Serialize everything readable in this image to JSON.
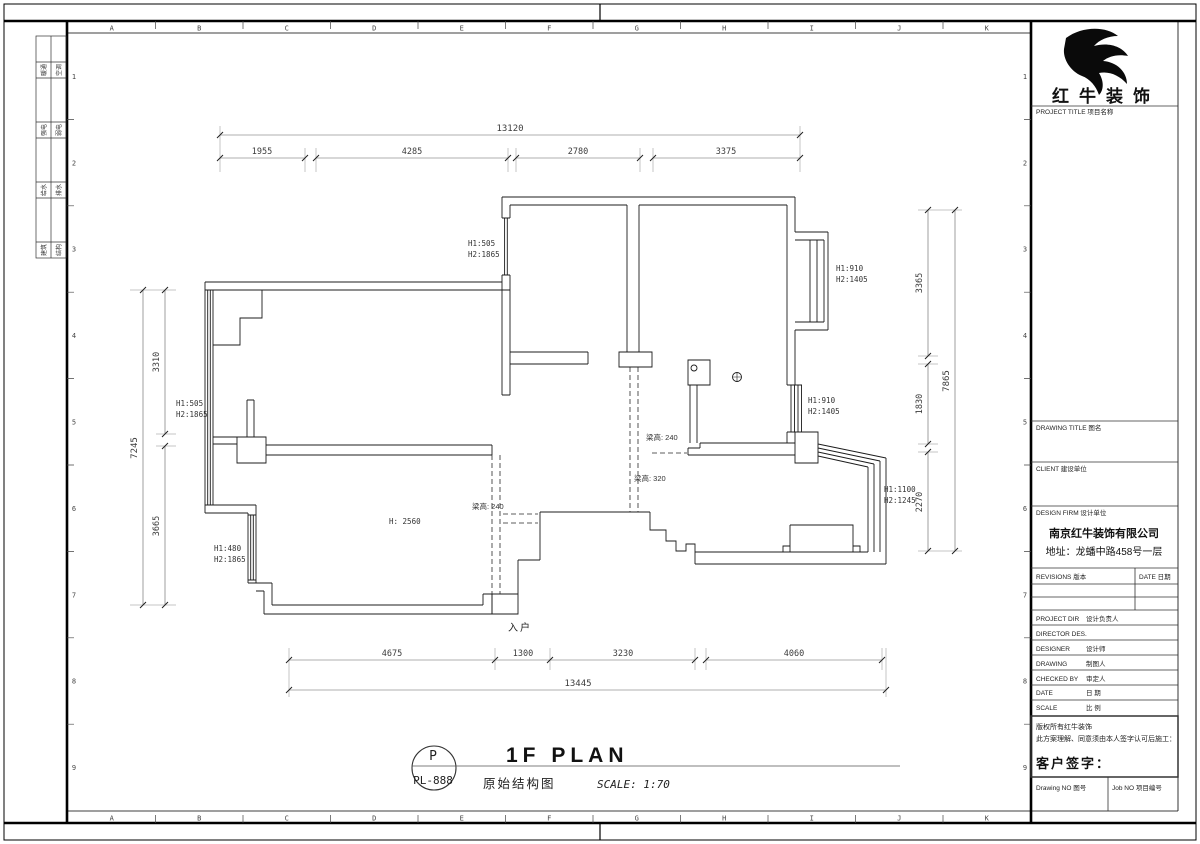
{
  "sheet": {
    "grid_letters": [
      "A",
      "B",
      "C",
      "D",
      "E",
      "F",
      "G",
      "H",
      "I",
      "J",
      "K"
    ],
    "grid_numbers": [
      "1",
      "2",
      "3",
      "4",
      "5",
      "6",
      "7",
      "8",
      "9"
    ]
  },
  "signoff": {
    "rows": [
      {
        "left": "暖通",
        "right": "空调"
      },
      {
        "left": "强电",
        "right": "弱电"
      },
      {
        "left": "给水",
        "right": "排水"
      },
      {
        "left": "建筑",
        "right": "结构"
      }
    ]
  },
  "dims": {
    "top": {
      "overall": "13120",
      "segments": [
        "1955",
        "4285",
        "2780",
        "3375"
      ]
    },
    "left": {
      "overall": "7245",
      "segments": [
        "3310",
        "3665"
      ]
    },
    "right": {
      "overall": "7865",
      "segments": [
        "3365",
        "1830",
        "2270"
      ]
    },
    "bottom": {
      "overall": "13445",
      "segments": [
        "4675",
        "1300",
        "3230",
        "4060"
      ]
    }
  },
  "plan": {
    "entry": "入户",
    "room_height": "H: 2560",
    "openings": [
      {
        "l1": "H1:505",
        "l2": "H2:1865"
      },
      {
        "l1": "H1:910",
        "l2": "H2:1405"
      },
      {
        "l1": "H1:505",
        "l2": "H2:1865"
      },
      {
        "l1": "H1:910",
        "l2": "H2:1405"
      },
      {
        "l1": "H1:1100",
        "l2": "H2:1245"
      },
      {
        "l1": "H1:480",
        "l2": "H2:1865"
      }
    ],
    "beams": [
      {
        "label": "梁高: 240"
      },
      {
        "label": "梁高: 320"
      },
      {
        "label": "梁高: 240"
      }
    ]
  },
  "titlebar": {
    "stamp_letter": "P",
    "stamp_number": "PL-888",
    "title_en": "1F PLAN",
    "title_cn": "原始结构图",
    "scale": "SCALE: 1:70"
  },
  "titleblock": {
    "brand": "红牛装饰",
    "project_title": "PROJECT TITLE  项目名称",
    "drawing_title": "DRAWING TITLE  图名",
    "client": "CLIENT  建设单位",
    "design_firm": "DESIGN FIRM  设计单位",
    "firm_name": "南京红牛装饰有限公司",
    "firm_address": "地址：龙蟠中路458号一层",
    "revisions": "REVISIONS  版本",
    "date_col": "DATE  日期",
    "rows": [
      {
        "en": "PROJECT DIR",
        "cn": "设计负责人"
      },
      {
        "en": "DIRECTOR DES.",
        "cn": ""
      },
      {
        "en": "DESIGNER",
        "cn": "设计师"
      },
      {
        "en": "DRAWING",
        "cn": "制图人"
      },
      {
        "en": "CHECKED BY",
        "cn": "审定人"
      },
      {
        "en": "DATE",
        "cn": "日  期"
      },
      {
        "en": "SCALE",
        "cn": "比  例"
      }
    ],
    "copyright_1": "版权所有红牛装饰",
    "copyright_2": "此方案理解、同意须由本人签字认可后施工：",
    "client_sign": "客户签字：",
    "drawing_no": "Drawing NO  图号",
    "job_no": "Job NO  项目编号"
  }
}
